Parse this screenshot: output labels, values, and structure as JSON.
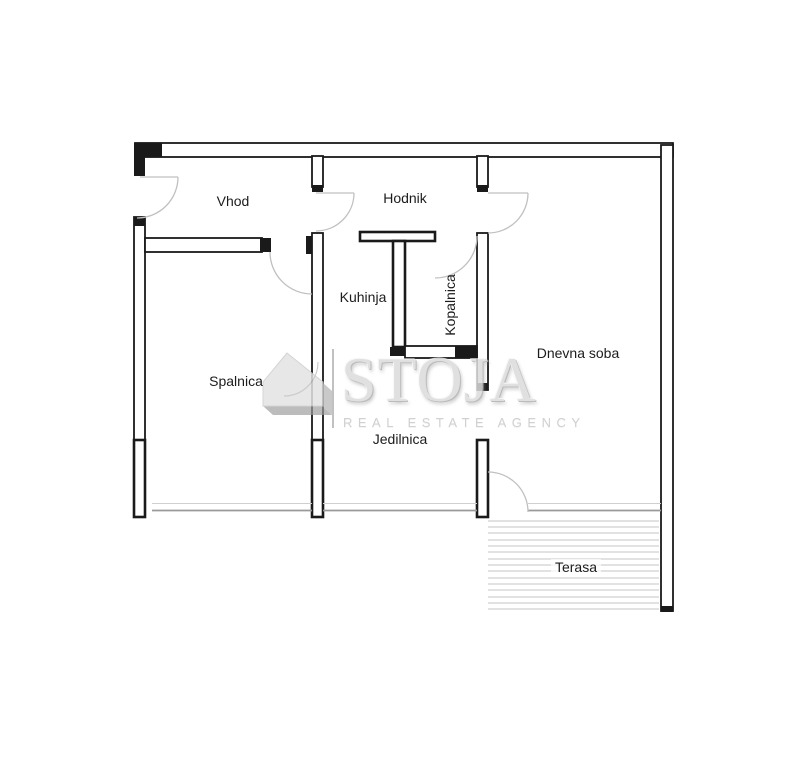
{
  "watermark": {
    "brand": "STOJA",
    "tagline": "REAL ESTATE AGENCY",
    "logo": "house-icon"
  },
  "rooms": {
    "vhod": {
      "label": "Vhod"
    },
    "hodnik": {
      "label": "Hodnik"
    },
    "kuhinja": {
      "label": "Kuhinja"
    },
    "kopalnica": {
      "label": "Kopalnica"
    },
    "spalnica": {
      "label": "Spalnica"
    },
    "dnevna_soba": {
      "label": "Dnevna soba"
    },
    "jedilnica": {
      "label": "Jedilnica"
    },
    "terasa": {
      "label": "Terasa"
    }
  },
  "colors": {
    "wall": "#1a1a1a",
    "door_arc": "#c0c0c0",
    "window": "#9a9a9a",
    "hatch": "#d8d8d8",
    "label_text": "#1c1c1c",
    "watermark_text": "#dbdbdb",
    "watermark_tagline": "#c9c9c9"
  }
}
